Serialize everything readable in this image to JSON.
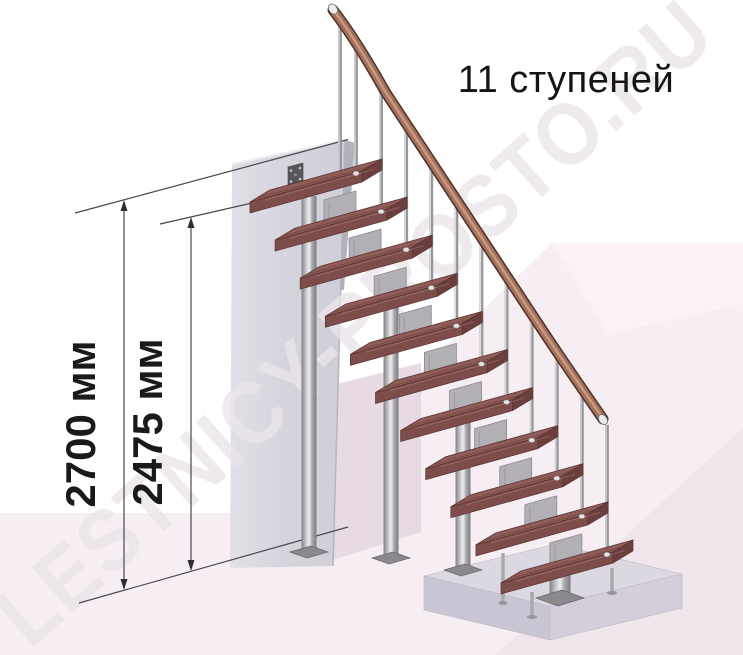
{
  "page": {
    "background": "#ffffff"
  },
  "title": {
    "text": "11 ступеней"
  },
  "watermark": {
    "text": "LESTNICY-PROSTO.RU"
  },
  "staircase": {
    "steps_count": 11,
    "support_columns_count": 4
  },
  "dimensions": [
    {
      "name": "floor-to-floor-height",
      "label": "2700 мм"
    },
    {
      "name": "floor-to-top-step-height",
      "label": "2475 мм"
    }
  ],
  "colors": {
    "floor": "#f7eef4",
    "floor_facet_light": "#fbf3f8",
    "floor_facet_dark": "#f1e5ec",
    "wall_shadow": "#e7dae3",
    "wall": "#d6d5dd",
    "plinth_top": "#dcd8e2",
    "step_top": "#8f5d59",
    "step_front": "#7c4d4a",
    "handrail": "#a2705b",
    "metal": "#c4c4c6",
    "dimension_line": "#4a474f",
    "text": "#141414"
  }
}
